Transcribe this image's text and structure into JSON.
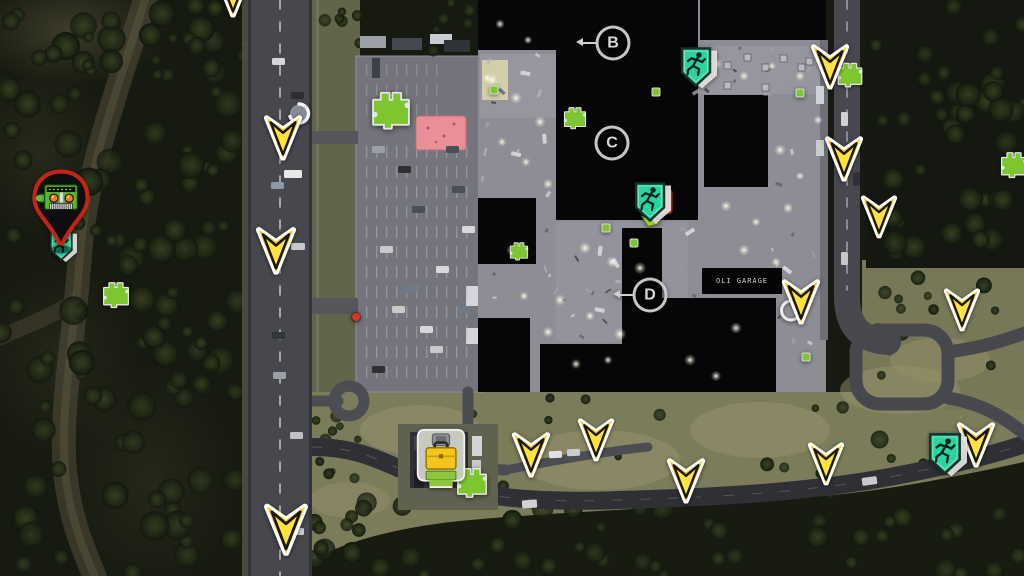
{
  "map": {
    "labels": {
      "garage": "OLI GARAGE"
    },
    "letters": [
      {
        "id": "B",
        "x": 613,
        "y": 43,
        "pointer": true
      },
      {
        "id": "C",
        "x": 612,
        "y": 143,
        "pointer": false
      },
      {
        "id": "D",
        "x": 650,
        "y": 295,
        "pointer": true
      }
    ],
    "markers": {
      "arrows": [
        {
          "x": 233,
          "y": -4,
          "s": 1
        },
        {
          "x": 283,
          "y": 139,
          "s": 1
        },
        {
          "x": 276,
          "y": 252,
          "s": 1.05
        },
        {
          "x": 830,
          "y": 68,
          "s": 1
        },
        {
          "x": 844,
          "y": 160,
          "s": 1
        },
        {
          "x": 879,
          "y": 218,
          "s": 0.95
        },
        {
          "x": 962,
          "y": 311,
          "s": 0.95
        },
        {
          "x": 801,
          "y": 303,
          "s": 1
        },
        {
          "x": 531,
          "y": 456,
          "s": 1
        },
        {
          "x": 596,
          "y": 441,
          "s": 0.95
        },
        {
          "x": 686,
          "y": 482,
          "s": 1
        },
        {
          "x": 826,
          "y": 465,
          "s": 0.95
        },
        {
          "x": 976,
          "y": 446,
          "s": 1
        },
        {
          "x": 286,
          "y": 531,
          "s": 1.15
        }
      ],
      "puzzles": [
        {
          "x": 116,
          "y": 296,
          "s": 1.0
        },
        {
          "x": 391,
          "y": 112,
          "s": 1.45
        },
        {
          "x": 575,
          "y": 119,
          "s": 0.85
        },
        {
          "x": 519,
          "y": 252,
          "s": 0.7
        },
        {
          "x": 850,
          "y": 76,
          "s": 0.95
        },
        {
          "x": 1014,
          "y": 166,
          "s": 1.0
        },
        {
          "x": 472,
          "y": 484,
          "s": 1.15
        }
      ],
      "exits": [
        {
          "x": 62,
          "y": 249,
          "variant": "plain",
          "s": 0.75
        },
        {
          "x": 697,
          "y": 71,
          "variant": "plain",
          "s": 1
        },
        {
          "x": 651,
          "y": 206,
          "variant": "door",
          "s": 1
        },
        {
          "x": 946,
          "y": 458,
          "variant": "plain",
          "s": 1.05
        }
      ],
      "icons": [
        {
          "type": "loop",
          "x": 299,
          "y": 116
        },
        {
          "type": "ring",
          "x": 791,
          "y": 313
        }
      ],
      "items": [
        {
          "x": 606,
          "y": 228
        },
        {
          "x": 634,
          "y": 243
        },
        {
          "x": 656,
          "y": 92
        },
        {
          "x": 494,
          "y": 90
        },
        {
          "x": 800,
          "y": 93
        },
        {
          "x": 806,
          "y": 357
        }
      ],
      "dots": [
        {
          "x": 356,
          "y": 317,
          "color": "#de3226"
        }
      ],
      "pin": {
        "x": 61,
        "y": 216
      },
      "briefcase": {
        "x": 441,
        "y": 462
      },
      "garage_label": {
        "x": 742,
        "y": 281
      }
    },
    "icon_names": {
      "arrow": "waypoint-arrow",
      "puzzle": "puzzle-piece",
      "exit": "running-man-exit",
      "pin": "generator-location-pin",
      "briefcase": "toolbox-trader",
      "loop": "loop-circle",
      "ring": "circle-outline"
    },
    "colors": {
      "arrow_yellow": "#f2c704",
      "puzzle_green": "#7dc62f",
      "exit_teal": "#2bd49e",
      "pin_red": "#c3241a",
      "door_red": "#d23a28",
      "briefcase_yellow": "#f6c51d",
      "building_pink": "#e98f97"
    }
  }
}
